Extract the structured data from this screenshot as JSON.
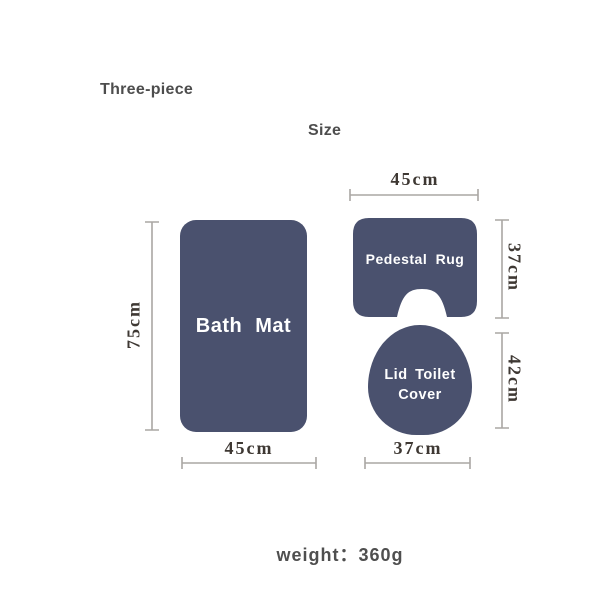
{
  "header": {
    "title": "Three-piece",
    "size_heading": "Size"
  },
  "bath_mat": {
    "label": "Bath Mat",
    "width_label": "45cm",
    "height_label": "75cm"
  },
  "pedestal_rug": {
    "label": "Pedestal Rug",
    "width_label": "45cm",
    "height_label": "37cm"
  },
  "lid_toilet_cover": {
    "label_line1": "Lid Toilet",
    "label_line2": "Cover",
    "width_label": "37cm",
    "height_label": "42cm"
  },
  "footer": {
    "weight_label": "weight：",
    "weight_value": "360g"
  },
  "colors": {
    "shape_fill": "#4a516e",
    "shape_label_text": "#ffffff",
    "dimension_line": "#aaa7a3",
    "dimension_text": "#3e3833",
    "heading_text": "#4d4d4d",
    "background": "#ffffff"
  }
}
